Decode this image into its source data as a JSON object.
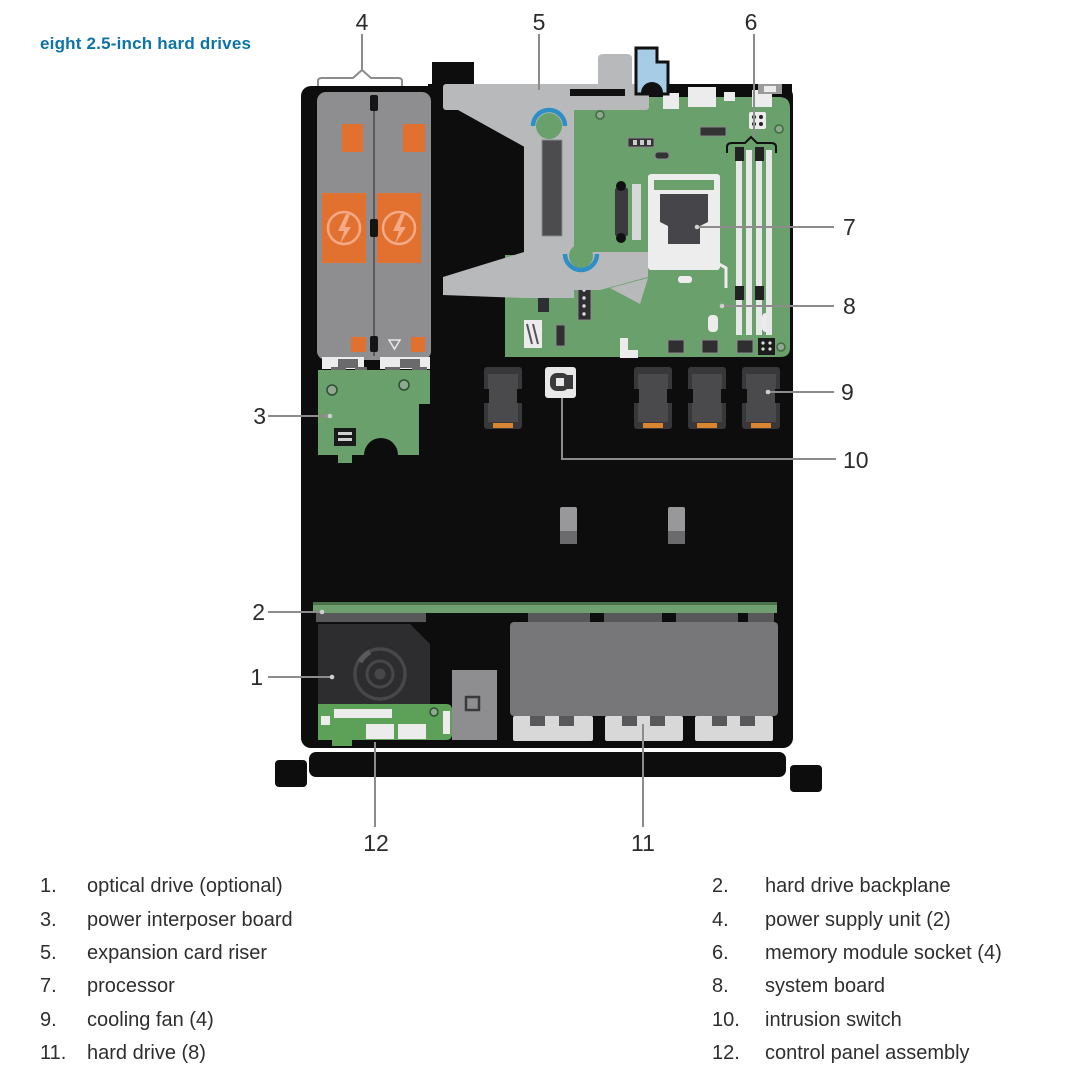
{
  "title": "eight 2.5-inch hard drives",
  "palette": {
    "title_blue": "#0C74A6",
    "board_green": "#69A06B",
    "control_panel_green": "#5DA158",
    "backplane_green": "#6F9E6F",
    "psu_orange": "#E2702E",
    "fan_orange": "#D9842E",
    "riser_gray": "#B8B9BB",
    "touchpoint_blue": "#2E8FC6",
    "latch_blue": "#A6CCE6",
    "chassis_black": "#0d0d0d",
    "callout_line_gray": "#8C8C8C"
  },
  "callouts": {
    "c1": "1",
    "c2": "2",
    "c3": "3",
    "c4": "4",
    "c5": "5",
    "c6": "6",
    "c7": "7",
    "c8": "8",
    "c9": "9",
    "c10": "10",
    "c11": "11",
    "c12": "12"
  },
  "legend": {
    "left": [
      {
        "num": "1.",
        "label": "optical drive (optional)"
      },
      {
        "num": "3.",
        "label": "power interposer board"
      },
      {
        "num": "5.",
        "label": "expansion card riser"
      },
      {
        "num": "7.",
        "label": "processor"
      },
      {
        "num": "9.",
        "label": "cooling fan (4)"
      },
      {
        "num": "11.",
        "label": "hard drive (8)"
      }
    ],
    "right": [
      {
        "num": "2.",
        "label": "hard drive backplane"
      },
      {
        "num": "4.",
        "label": "power supply unit (2)"
      },
      {
        "num": "6.",
        "label": "memory module socket (4)"
      },
      {
        "num": "8.",
        "label": "system board"
      },
      {
        "num": "10.",
        "label": "intrusion switch"
      },
      {
        "num": "12.",
        "label": "control panel assembly"
      }
    ]
  }
}
